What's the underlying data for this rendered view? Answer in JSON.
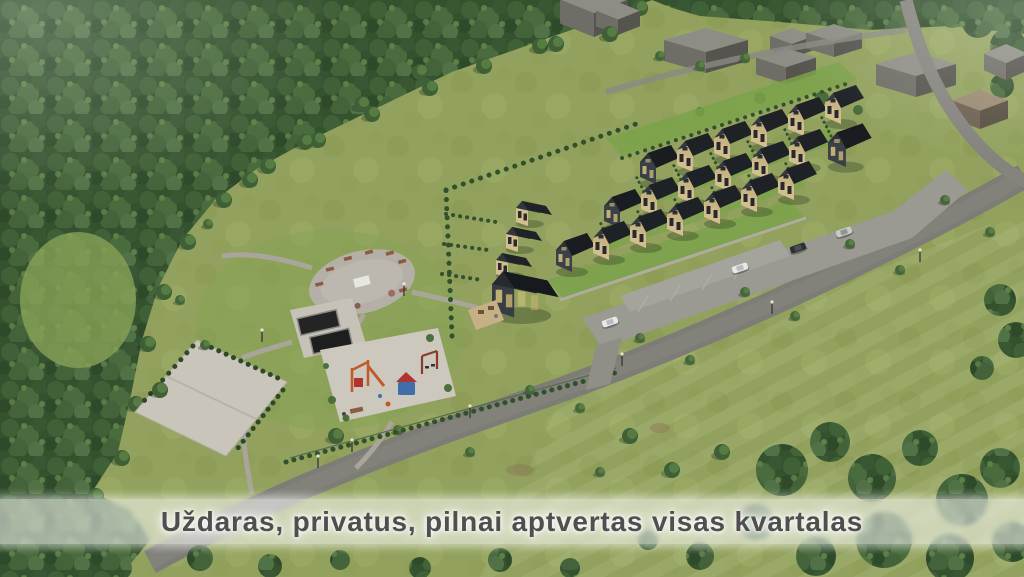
{
  "caption": {
    "text": "Uždaras, privatus, pilnai aptvertas visas kvartalas"
  },
  "colors": {
    "caption_band": "rgba(253,253,252,0.55)",
    "caption_text": "#4f4f4f",
    "forest": "#3a5733",
    "meadow": "#92a25e",
    "roof": "#22262a",
    "facade_timber": "#d3be90",
    "road": "#7d7c76",
    "neighbor_block": "#8b8a82",
    "plaza": "#b4b0a7",
    "court": "#cac5ba"
  },
  "scene": {
    "alt": "Aerial 3D visualization of a gated residential quarter: rows of dark-roofed timber townhouses with gardens, internal street with parked cars, playground, trampolines, oval seating plaza and sports court, surrounded by forest, meadows and gray neighboring buildings"
  }
}
